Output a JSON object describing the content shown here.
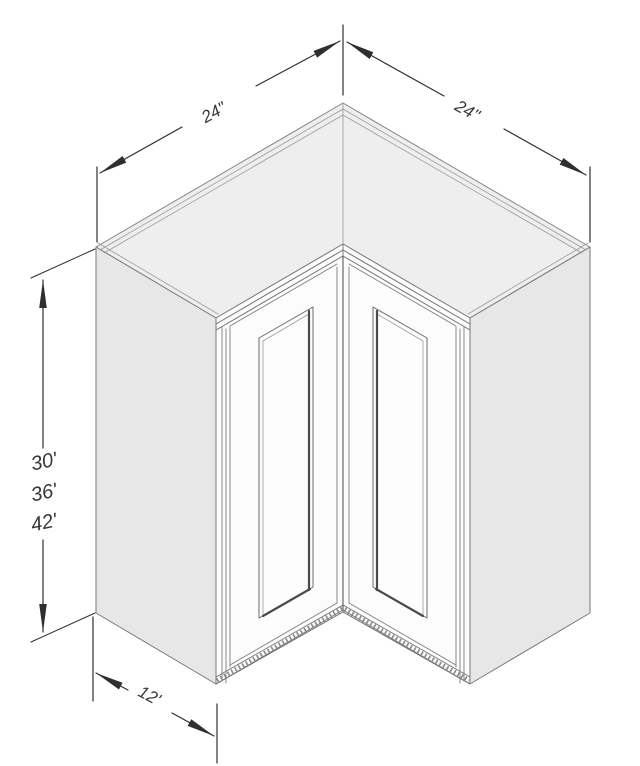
{
  "diagram": {
    "dimensions": {
      "width_left": "24\"",
      "width_right": "24\"",
      "height_options": [
        "30'",
        "36'",
        "42'"
      ],
      "depth": "12'"
    },
    "colors": {
      "background": "#ffffff",
      "dimension_line": "#2f2f2f",
      "cabinet_edge": "#777777",
      "top_face": "#eeeeee",
      "side_face": "#e7e7e7",
      "front_face": "#fcfcfc",
      "panel_shadow": "#4a4a4a"
    }
  }
}
